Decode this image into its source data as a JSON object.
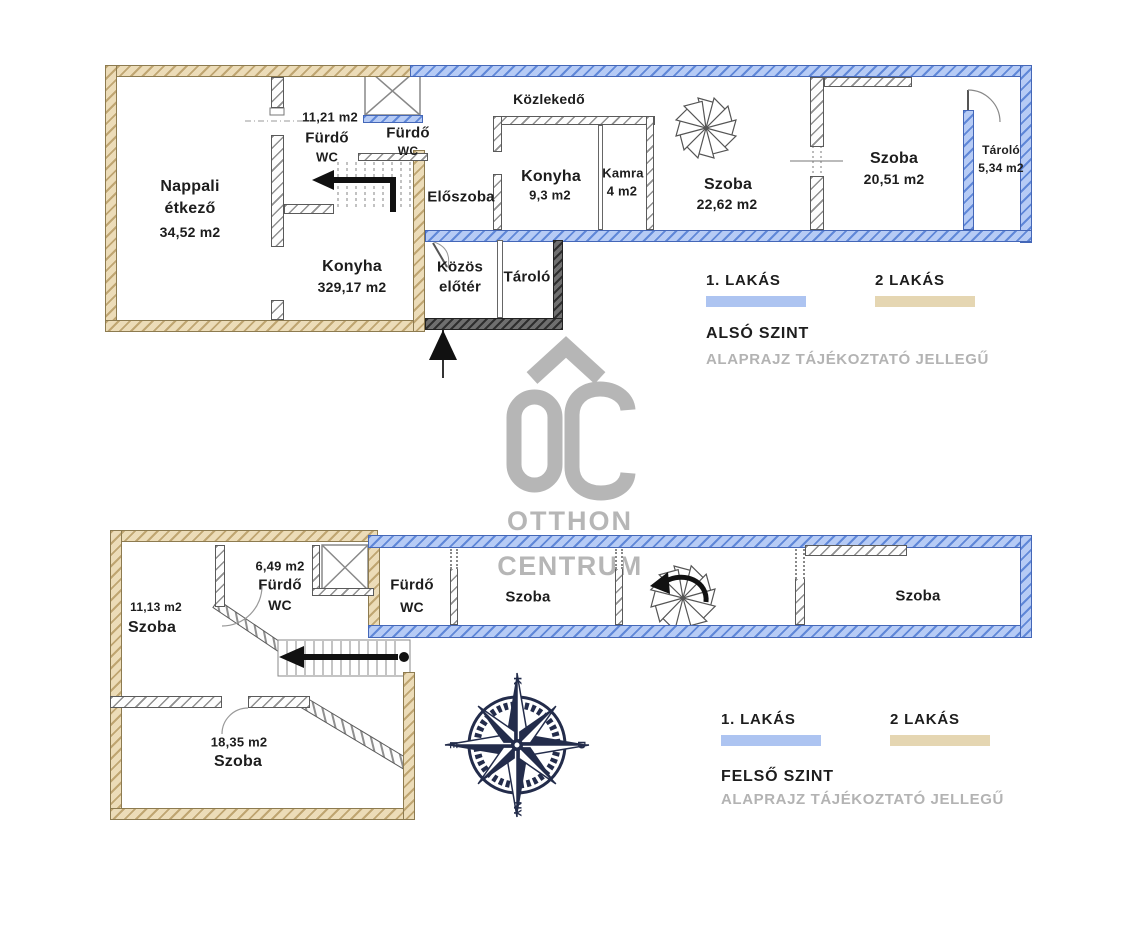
{
  "colors": {
    "apartment1_blue": "#adc4f1",
    "apartment2_tan": "#e5d6b2",
    "interior_wall_gray": "#8f8f8f",
    "entry_wall_dark": "#4f4f4f",
    "compass_navy": "#232c4b",
    "watermark_gray": "#b6b6b6",
    "label_text": "#1d1d1d",
    "disclaimer_gray": "#b3b3b3"
  },
  "watermark": {
    "monogram": "ŐC",
    "line1": "OTTHON",
    "line2": "CENTRUM"
  },
  "compass": {
    "top": "K",
    "right": "D",
    "bottom": "NY",
    "left": "É"
  },
  "also_szint": {
    "legend": {
      "apt1": "1. LAKÁS",
      "apt2": "2 LAKÁS",
      "title": "ALSÓ SZINT",
      "disclaimer": "ALAPRAJZ TÁJÉKOZTATÓ JELLEGŰ"
    },
    "rooms": {
      "nappali": {
        "line1": "Nappali",
        "line2": "étkező",
        "area": "34,52 m2"
      },
      "furdo_tan": {
        "area": "11,21 m2",
        "line1": "Fürdő",
        "line2": "WC"
      },
      "konyha_tan": {
        "name": "Konyha",
        "area": "329,17 m2"
      },
      "kozlekedo": {
        "name": "Közlekedő"
      },
      "furdo_blue": {
        "line1": "Fürdő",
        "line2": "WC"
      },
      "eloszoba": {
        "name": "Előszoba"
      },
      "konyha_blue": {
        "name": "Konyha",
        "area": "9,3 m2"
      },
      "kamra": {
        "name": "Kamra",
        "area": "4 m2"
      },
      "szoba_kozep": {
        "name": "Szoba",
        "area": "22,62 m2"
      },
      "szoba_jobb": {
        "name": "Szoba",
        "area": "20,51 m2"
      },
      "tarolo_jobb": {
        "name": "Tároló",
        "area": "5,34 m2"
      },
      "kozos_eloter": {
        "line1": "Közös",
        "line2": "előtér"
      },
      "tarolo_kozep": {
        "name": "Tároló"
      }
    }
  },
  "felso_szint": {
    "legend": {
      "apt1": "1. LAKÁS",
      "apt2": "2 LAKÁS",
      "title": "FELSŐ SZINT",
      "disclaimer": "ALAPRAJZ TÁJÉKOZTATÓ JELLEGŰ"
    },
    "rooms": {
      "szoba_bal": {
        "area": "11,13 m2",
        "name": "Szoba"
      },
      "furdo_tan": {
        "area": "6,49 m2",
        "line1": "Fürdő",
        "line2": "WC"
      },
      "szoba_also": {
        "area": "18,35 m2",
        "name": "Szoba"
      },
      "furdo_blue": {
        "line1": "Fürdő",
        "line2": "WC"
      },
      "szoba_kozep": {
        "name": "Szoba"
      },
      "szoba_jobb": {
        "name": "Szoba"
      }
    }
  }
}
